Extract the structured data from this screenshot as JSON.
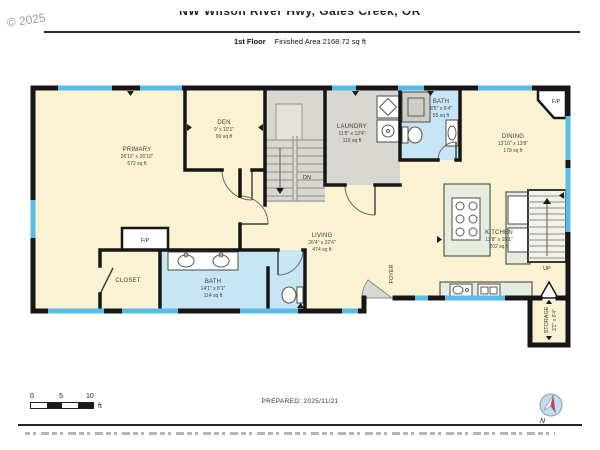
{
  "header": {
    "copyright": "© 2025",
    "address": "NW Wilson River Hwy, Gales Creek, OR",
    "floor_label": "1st Floor",
    "area_label": "Finished Area 2168.72 sq ft"
  },
  "plan": {
    "rooms": {
      "primary": {
        "name": "PRIMARY",
        "dims": "26'11\" x 26'10\"",
        "area": "572 sq ft"
      },
      "den": {
        "name": "DEN",
        "dims": "9' x 10'1\"",
        "area": "90 sq ft"
      },
      "laundry": {
        "name": "LAUNDRY",
        "dims": "11'5\" x 12'4\"",
        "area": "116 sq ft"
      },
      "bath_top": {
        "name": "BATH",
        "dims": "8'5\" x 6'4\"",
        "area": "55 sq ft"
      },
      "dining": {
        "name": "DINING",
        "dims": "13'10\" x 13'8\"",
        "area": "179 sq ft"
      },
      "kitchen": {
        "name": "KITCHEN",
        "dims": "13'8\" x 15'1\"",
        "area": "202 sq ft"
      },
      "living": {
        "name": "LIVING",
        "dims": "26'4\" x 22'4\"",
        "area": "474 sq ft"
      },
      "bath_bottom": {
        "name": "BATH",
        "dims": "14'1\" x 8'1\"",
        "area": "114 sq ft"
      },
      "closet": {
        "name": "CLOSET"
      },
      "foyer": {
        "name": "FOYER"
      },
      "storage": {
        "name": "STORAGE",
        "dims": "3'2\" x 6'4\""
      }
    },
    "annotations": {
      "stairs_down": "DN",
      "stairs_up": "UP",
      "fireplace": "F/P"
    }
  },
  "footer": {
    "scale": {
      "tick0": "0",
      "tick1": "5",
      "tick2": "10",
      "unit": "ft"
    },
    "prepared": "PREPARED: 2025/11/21",
    "compass_label": "N"
  },
  "colors": {
    "wall": "#161616",
    "floor": "#FBF1D3",
    "wet": "#C7E5F4",
    "window": "#58BCE9",
    "hard": "#D8D7D2",
    "counter": "#E4EDE0",
    "compass": "#BFE0F2",
    "needle_red": "#E8274B"
  }
}
